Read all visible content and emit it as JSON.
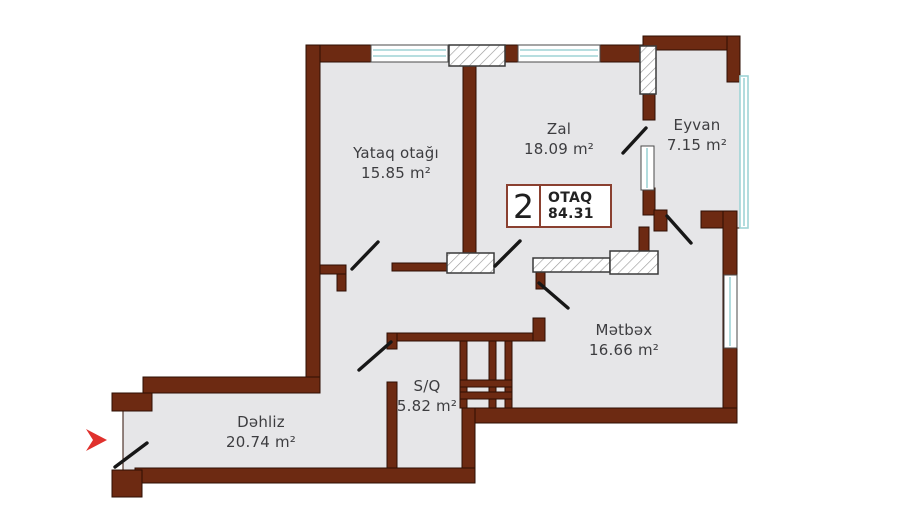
{
  "floorplan": {
    "badge": {
      "rooms_count": "2",
      "label": "OTAQ",
      "total_area": "84.31"
    },
    "rooms": [
      {
        "id": "yataq-otagi",
        "name": "Yataq otağı",
        "area": "15.85 m²"
      },
      {
        "id": "zal",
        "name": "Zal",
        "area": "18.09 m²"
      },
      {
        "id": "eyvan",
        "name": "Eyvan",
        "area": "7.15 m²"
      },
      {
        "id": "metbex",
        "name": "Mətbəx",
        "area": "16.66 m²"
      },
      {
        "id": "sq",
        "name": "S/Q",
        "area": "5.82 m²"
      },
      {
        "id": "dehliz",
        "name": "Dəhliz",
        "area": "20.74 m²"
      }
    ],
    "colors": {
      "wall": "#6d2a12",
      "wall_outline": "#2e0f03",
      "floor": "#e6e6e8",
      "glass": "#9fd4d6",
      "door": "#171717",
      "entrance_arrow": "#e0312d"
    }
  }
}
